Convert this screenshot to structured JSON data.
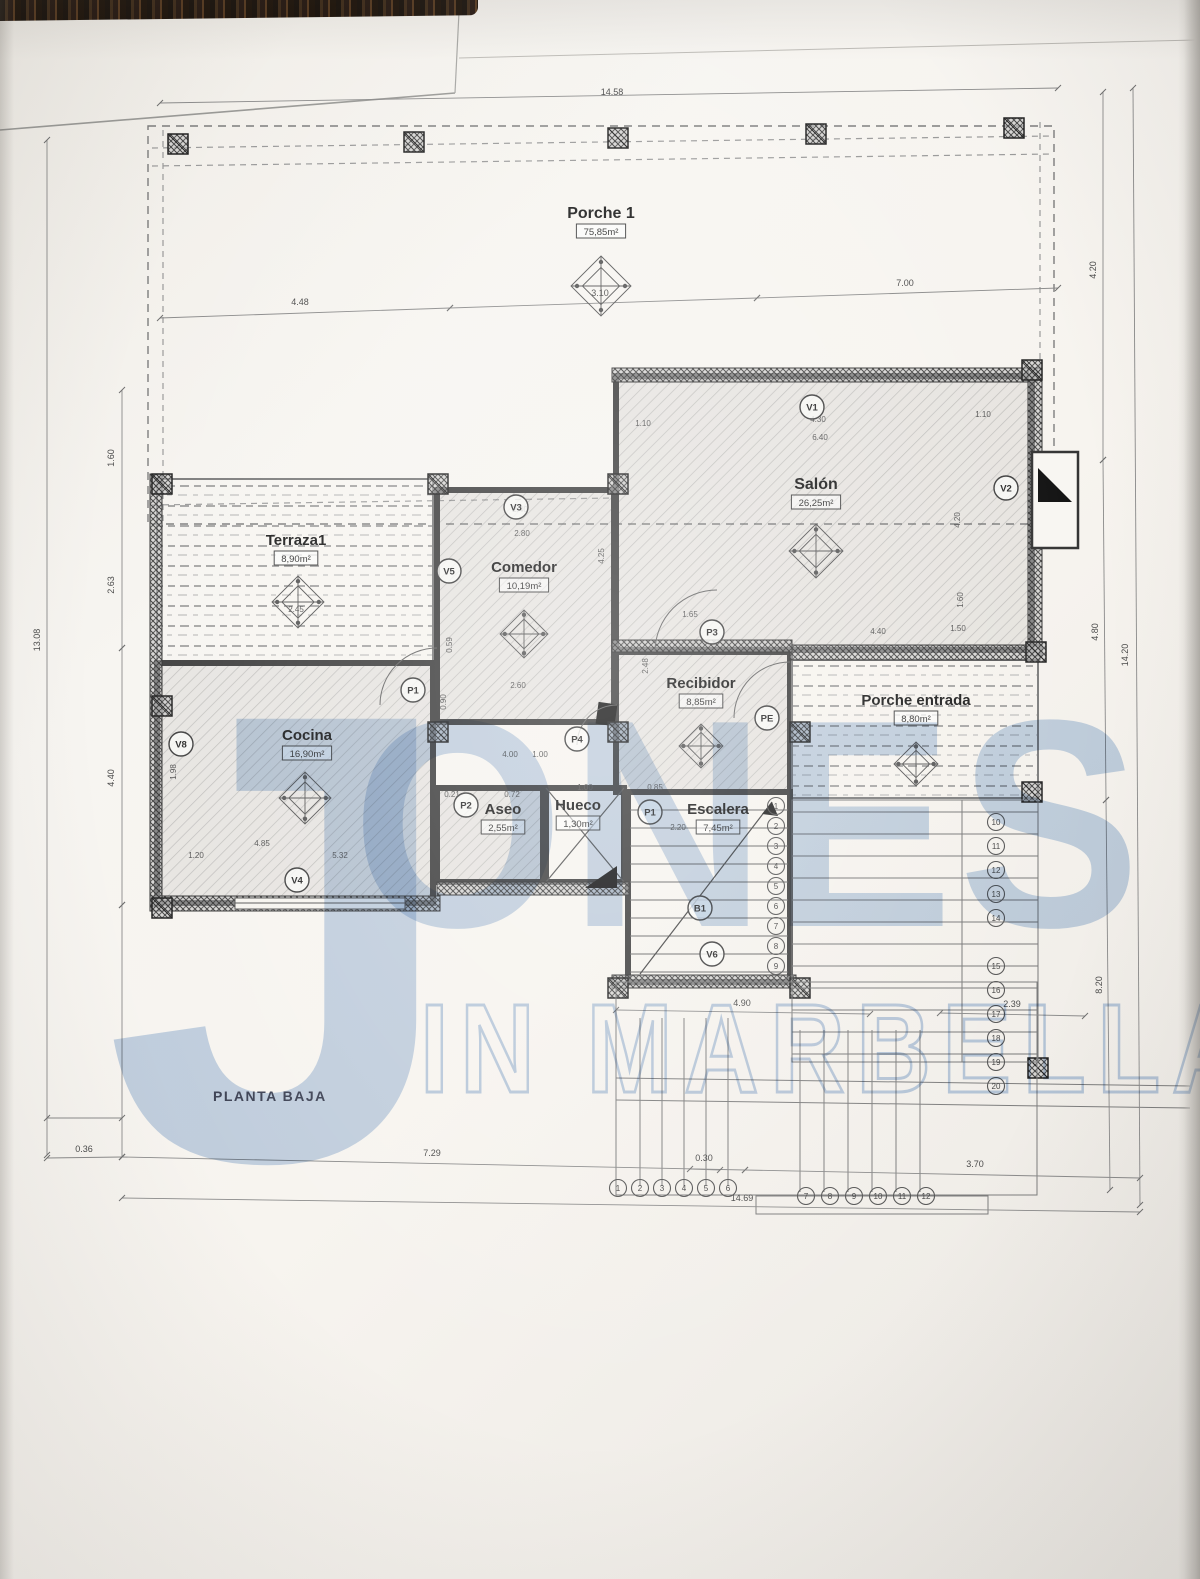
{
  "title": "PLANTA BAJA",
  "watermark": {
    "j": "J",
    "ones": "ONES",
    "line2": "IN MARBELLA",
    "color": "#a3becf"
  },
  "colors": {
    "paper": "#f6f4ef",
    "line": "#8a8a8a",
    "wall": "#3f3f3f",
    "dim": "#4a4a4a",
    "label": "#1e1e1e",
    "watermark_blue": "#a3bedf"
  },
  "rooms": [
    {
      "id": "porche1",
      "name": "Porche 1",
      "area": "75,85m²",
      "label": [
        601,
        218
      ],
      "rect": [
        148,
        126,
        906,
        398
      ],
      "fill": "none",
      "wall": "dashed",
      "ornament": [
        601,
        286
      ],
      "osize": 30
    },
    {
      "id": "terraza1",
      "name": "Terraza1",
      "area": "8,90m²",
      "label": [
        296,
        545
      ],
      "rect": [
        157,
        479,
        276,
        184
      ],
      "fill": "dashrows",
      "wall": "thin",
      "ornament": [
        298,
        602
      ],
      "osize": 26
    },
    {
      "id": "comedor",
      "name": "Comedor",
      "area": "10,19m²",
      "label": [
        524,
        572
      ],
      "rect": [
        437,
        490,
        177,
        232
      ],
      "fill": "hatch",
      "wall": "thick",
      "ornament": [
        524,
        634
      ],
      "osize": 24
    },
    {
      "id": "salon",
      "name": "Salón",
      "area": "26,25m²",
      "label": [
        816,
        489
      ],
      "rect": [
        616,
        376,
        416,
        274
      ],
      "fill": "hatch",
      "wall": "thick",
      "ornament": [
        816,
        551
      ],
      "osize": 27
    },
    {
      "id": "cocina",
      "name": "Cocina",
      "area": "16,90m²",
      "label": [
        307,
        740
      ],
      "rect": [
        157,
        663,
        276,
        240
      ],
      "fill": "hatch",
      "wall": "thick",
      "ornament": [
        305,
        798
      ],
      "osize": 26
    },
    {
      "id": "recibidor",
      "name": "Recibidor",
      "area": "8,85m²",
      "label": [
        701,
        688
      ],
      "rect": [
        616,
        652,
        174,
        140
      ],
      "fill": "hatch",
      "wall": "thick",
      "ornament": [
        701,
        746
      ],
      "osize": 22
    },
    {
      "id": "porche-entrada",
      "name": "Porche entrada",
      "area": "8,80m²",
      "label": [
        916,
        705
      ],
      "rect": [
        792,
        660,
        246,
        138
      ],
      "fill": "dashrows",
      "wall": "thin",
      "ornament": [
        916,
        764
      ],
      "osize": 22
    },
    {
      "id": "aseo",
      "name": "Aseo",
      "area": "2,55m²",
      "label": [
        503,
        814
      ],
      "rect": [
        437,
        788,
        106,
        94
      ],
      "fill": "hatch",
      "wall": "thick",
      "ornament": null,
      "osize": 0
    },
    {
      "id": "hueco",
      "name": "Hueco",
      "area": "1,30m²",
      "label": [
        578,
        810
      ],
      "rect": [
        546,
        788,
        78,
        94
      ],
      "fill": "cross",
      "wall": "thick",
      "ornament": null,
      "osize": 0
    },
    {
      "id": "escalera",
      "name": "Escalera",
      "area": "7,45m²",
      "label": [
        718,
        814
      ],
      "rect": [
        628,
        792,
        162,
        190
      ],
      "fill": "stairs",
      "wall": "thick",
      "ornament": null,
      "osize": 0
    }
  ],
  "openings": [
    {
      "text": "V1",
      "cx": 812,
      "cy": 407
    },
    {
      "text": "V3",
      "cx": 516,
      "cy": 507
    },
    {
      "text": "V5",
      "cx": 449,
      "cy": 571
    },
    {
      "text": "V2",
      "cx": 1006,
      "cy": 488
    },
    {
      "text": "V8",
      "cx": 181,
      "cy": 744
    },
    {
      "text": "V4",
      "cx": 297,
      "cy": 880
    },
    {
      "text": "V6",
      "cx": 712,
      "cy": 954
    },
    {
      "text": "B1",
      "cx": 700,
      "cy": 908
    },
    {
      "text": "P1",
      "cx": 413,
      "cy": 690
    },
    {
      "text": "P2",
      "cx": 466,
      "cy": 805
    },
    {
      "text": "P3",
      "cx": 712,
      "cy": 632
    },
    {
      "text": "P4",
      "cx": 577,
      "cy": 739
    },
    {
      "text": "P1",
      "cx": 650,
      "cy": 812
    },
    {
      "text": "PE",
      "cx": 767,
      "cy": 718
    }
  ],
  "dim_lines": [
    {
      "x1": 160,
      "y1": 103,
      "x2": 1058,
      "y2": 88
    },
    {
      "x1": 160,
      "y1": 318,
      "x2": 450,
      "y2": 308
    },
    {
      "x1": 450,
      "y1": 308,
      "x2": 757,
      "y2": 298
    },
    {
      "x1": 757,
      "y1": 298,
      "x2": 1058,
      "y2": 288
    },
    {
      "x1": 47,
      "y1": 140,
      "x2": 47,
      "y2": 1155
    },
    {
      "x1": 122,
      "y1": 390,
      "x2": 122,
      "y2": 648
    },
    {
      "x1": 122,
      "y1": 648,
      "x2": 122,
      "y2": 905
    },
    {
      "x1": 122,
      "y1": 905,
      "x2": 122,
      "y2": 1157
    },
    {
      "x1": 1103,
      "y1": 92,
      "x2": 1103,
      "y2": 460
    },
    {
      "x1": 1103,
      "y1": 460,
      "x2": 1106,
      "y2": 800
    },
    {
      "x1": 1106,
      "y1": 800,
      "x2": 1110,
      "y2": 1190
    },
    {
      "x1": 1133,
      "y1": 88,
      "x2": 1140,
      "y2": 1205
    },
    {
      "x1": 47,
      "y1": 1158,
      "x2": 122,
      "y2": 1157
    },
    {
      "x1": 122,
      "y1": 1157,
      "x2": 745,
      "y2": 1170
    },
    {
      "x1": 745,
      "y1": 1170,
      "x2": 1140,
      "y2": 1178
    },
    {
      "x1": 122,
      "y1": 1198,
      "x2": 1140,
      "y2": 1212
    },
    {
      "x1": 616,
      "y1": 1010,
      "x2": 870,
      "y2": 1014
    },
    {
      "x1": 940,
      "y1": 1013,
      "x2": 1085,
      "y2": 1016
    },
    {
      "x1": 690,
      "y1": 1169,
      "x2": 720,
      "y2": 1170
    },
    {
      "x1": 47,
      "y1": 1118,
      "x2": 122,
      "y2": 1118
    }
  ],
  "dim_labels": [
    {
      "t": "14.58",
      "x": 612,
      "y": 95,
      "r": 0
    },
    {
      "t": "4.48",
      "x": 300,
      "y": 305,
      "r": 0
    },
    {
      "t": "3.10",
      "x": 600,
      "y": 296,
      "r": 0
    },
    {
      "t": "7.00",
      "x": 905,
      "y": 286,
      "r": 0
    },
    {
      "t": "13.08",
      "x": 40,
      "y": 640,
      "r": -90
    },
    {
      "t": "1.60",
      "x": 114,
      "y": 458,
      "r": -90
    },
    {
      "t": "2.63",
      "x": 114,
      "y": 585,
      "r": -90
    },
    {
      "t": "4.40",
      "x": 114,
      "y": 778,
      "r": -90
    },
    {
      "t": "4.20",
      "x": 1096,
      "y": 270,
      "r": -90
    },
    {
      "t": "4.80",
      "x": 1098,
      "y": 632,
      "r": -90
    },
    {
      "t": "8.20",
      "x": 1102,
      "y": 985,
      "r": -90
    },
    {
      "t": "14.20",
      "x": 1128,
      "y": 655,
      "r": -90
    },
    {
      "t": "0.36",
      "x": 84,
      "y": 1152,
      "r": 0
    },
    {
      "t": "7.29",
      "x": 432,
      "y": 1156,
      "r": 0
    },
    {
      "t": "0.30",
      "x": 704,
      "y": 1161,
      "r": 0
    },
    {
      "t": "3.70",
      "x": 975,
      "y": 1167,
      "r": 0
    },
    {
      "t": "14.69",
      "x": 742,
      "y": 1201,
      "r": 0
    },
    {
      "t": "4.90",
      "x": 742,
      "y": 1006,
      "r": 0
    },
    {
      "t": "2.39",
      "x": 1012,
      "y": 1007,
      "r": 0
    }
  ],
  "inner_dims": [
    {
      "t": "1.10",
      "x": 643,
      "y": 426,
      "r": 0
    },
    {
      "t": "4.30",
      "x": 818,
      "y": 422,
      "r": 0
    },
    {
      "t": "1.10",
      "x": 983,
      "y": 417,
      "r": 0
    },
    {
      "t": "6.40",
      "x": 820,
      "y": 440,
      "r": 0
    },
    {
      "t": "4.20",
      "x": 960,
      "y": 520,
      "r": -90
    },
    {
      "t": "1.60",
      "x": 963,
      "y": 600,
      "r": -90
    },
    {
      "t": "4.40",
      "x": 878,
      "y": 634,
      "r": 0
    },
    {
      "t": "1.50",
      "x": 958,
      "y": 631,
      "r": 0
    },
    {
      "t": "2.40",
      "x": 520,
      "y": 512,
      "r": 0
    },
    {
      "t": "2.80",
      "x": 522,
      "y": 536,
      "r": 0
    },
    {
      "t": "4.25",
      "x": 604,
      "y": 556,
      "r": -90
    },
    {
      "t": "0.59",
      "x": 452,
      "y": 645,
      "r": -90
    },
    {
      "t": "2.60",
      "x": 518,
      "y": 688,
      "r": 0
    },
    {
      "t": "0.90",
      "x": 446,
      "y": 702,
      "r": -90
    },
    {
      "t": "4.00",
      "x": 510,
      "y": 757,
      "r": 0
    },
    {
      "t": "1.00",
      "x": 540,
      "y": 757,
      "r": 0
    },
    {
      "t": "1.65",
      "x": 690,
      "y": 617,
      "r": 0
    },
    {
      "t": "2.48",
      "x": 648,
      "y": 666,
      "r": -90
    },
    {
      "t": "1.98",
      "x": 176,
      "y": 772,
      "r": -90
    },
    {
      "t": "4.85",
      "x": 262,
      "y": 846,
      "r": 0
    },
    {
      "t": "5.32",
      "x": 340,
      "y": 858,
      "r": 0
    },
    {
      "t": "1.20",
      "x": 196,
      "y": 858,
      "r": 0
    },
    {
      "t": "2.45",
      "x": 296,
      "y": 612,
      "r": 0
    },
    {
      "t": "0.21",
      "x": 452,
      "y": 797,
      "r": 0
    },
    {
      "t": "0.72",
      "x": 512,
      "y": 797,
      "r": 0
    },
    {
      "t": "1.00",
      "x": 585,
      "y": 790,
      "r": 0
    },
    {
      "t": "0.85",
      "x": 655,
      "y": 790,
      "r": 0
    },
    {
      "t": "2.20",
      "x": 678,
      "y": 830,
      "r": 0
    }
  ],
  "stair_numbers": {
    "inner_col": {
      "x": 776,
      "y0": 806,
      "step": 20,
      "nums": [
        "1",
        "2",
        "3",
        "4",
        "5",
        "6",
        "7",
        "8",
        "9"
      ]
    },
    "right_col_a": {
      "x": 996,
      "y0": 822,
      "step": 24,
      "nums": [
        "10",
        "11",
        "12",
        "13",
        "14"
      ]
    },
    "right_col_b": {
      "x": 996,
      "y0": 966,
      "step": 24,
      "nums": [
        "15",
        "16",
        "17",
        "18",
        "19",
        "20"
      ]
    },
    "bottom_row_a": {
      "y": 1188,
      "x0": 618,
      "step": 22,
      "nums": [
        "1",
        "2",
        "3",
        "4",
        "5",
        "6"
      ]
    },
    "bottom_row_b": {
      "y": 1196,
      "x0": 806,
      "step": 24,
      "nums": [
        "7",
        "8",
        "9",
        "10",
        "11",
        "12"
      ]
    }
  },
  "pillars": [
    [
      168,
      134
    ],
    [
      404,
      132
    ],
    [
      608,
      128
    ],
    [
      806,
      124
    ],
    [
      1004,
      118
    ],
    [
      152,
      474
    ],
    [
      152,
      696
    ],
    [
      152,
      898
    ],
    [
      1022,
      360
    ],
    [
      1026,
      642
    ],
    [
      1022,
      782
    ],
    [
      428,
      474
    ],
    [
      608,
      474
    ],
    [
      428,
      722
    ],
    [
      608,
      722
    ],
    [
      790,
      722
    ],
    [
      608,
      978
    ],
    [
      790,
      978
    ],
    [
      1028,
      1058
    ]
  ]
}
